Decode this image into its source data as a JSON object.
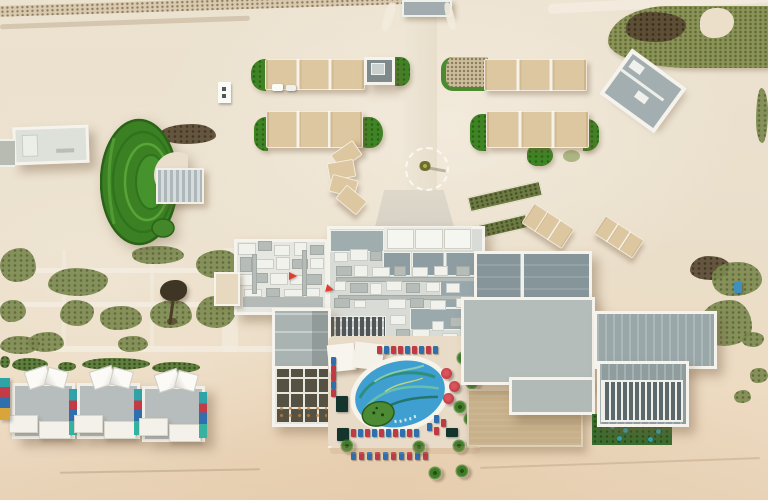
{
  "scene": {
    "type": "aerial-photograph",
    "subject": "top-down aerial view of a beachfront desert resort with amphitheater lawn, shade canopies, rooftop HVAC complex, mural swimming pool, beach villas and loungers"
  },
  "palette": {
    "sand": "#eadfcc",
    "beach": "#e8d4b9",
    "path": "#f3ecdf",
    "canopy": "#ddc7a0",
    "grass": "#3f8424",
    "grass_dark": "#2a6317",
    "olive": "#7d8b50",
    "scrub_dark": "#5a4a33",
    "roof_gray": "#a9b3b1",
    "roof_dark": "#869599",
    "concrete": "#b5bdba",
    "roof_light": "#e6e7e1",
    "tan_roof": "#c7b08a",
    "pool": "#3f9fd0",
    "teal": "#2f8f78",
    "lawn": "#3c6d2e",
    "red": "#c03a45",
    "blue": "#2f6fae",
    "flag": "#e23b30",
    "white": "#f5f3ec"
  },
  "objects": {
    "canopy_rows": [
      [
        265,
        59,
        98,
        29,
        0
      ],
      [
        484,
        59,
        101,
        30,
        0
      ],
      [
        266,
        111,
        95,
        35,
        0
      ],
      [
        486,
        111,
        101,
        35,
        0
      ],
      [
        524,
        214,
        46,
        22,
        33
      ],
      [
        596,
        226,
        44,
        20,
        33
      ]
    ],
    "canopy_fan": [
      [
        333,
        146,
        25,
        16,
        -35
      ],
      [
        328,
        161,
        25,
        16,
        -10
      ],
      [
        330,
        177,
        25,
        16,
        15
      ],
      [
        338,
        191,
        25,
        16,
        40
      ]
    ],
    "equipment": [
      [
        238,
        243,
        16,
        10,
        "w"
      ],
      [
        258,
        241,
        12,
        8,
        "g"
      ],
      [
        274,
        245,
        14,
        9,
        "w"
      ],
      [
        294,
        242,
        11,
        12,
        "w"
      ],
      [
        310,
        245,
        12,
        8,
        "g"
      ],
      [
        240,
        257,
        10,
        13,
        "g"
      ],
      [
        254,
        259,
        18,
        8,
        "w"
      ],
      [
        276,
        257,
        12,
        11,
        "w"
      ],
      [
        292,
        259,
        14,
        8,
        "g"
      ],
      [
        310,
        258,
        12,
        9,
        "w"
      ],
      [
        238,
        274,
        14,
        10,
        "w"
      ],
      [
        256,
        273,
        10,
        8,
        "g"
      ],
      [
        270,
        273,
        16,
        10,
        "w"
      ],
      [
        290,
        275,
        12,
        8,
        "w"
      ],
      [
        306,
        274,
        14,
        9,
        "g"
      ],
      [
        244,
        289,
        16,
        6,
        "w"
      ],
      [
        266,
        288,
        12,
        7,
        "g"
      ],
      [
        284,
        289,
        18,
        6,
        "w"
      ],
      [
        306,
        288,
        12,
        7,
        "w"
      ],
      [
        252,
        254,
        3,
        38,
        "g"
      ],
      [
        302,
        250,
        3,
        44,
        "g"
      ],
      [
        334,
        252,
        12,
        8,
        "w"
      ],
      [
        350,
        249,
        16,
        10,
        "w"
      ],
      [
        370,
        251,
        10,
        8,
        "g"
      ],
      [
        336,
        277,
        138,
        3,
        "g"
      ],
      [
        338,
        295,
        134,
        3,
        "g"
      ],
      [
        336,
        266,
        14,
        8,
        "g"
      ],
      [
        354,
        265,
        12,
        10,
        "w"
      ],
      [
        372,
        267,
        16,
        8,
        "w"
      ],
      [
        394,
        266,
        10,
        8,
        "g"
      ],
      [
        412,
        267,
        14,
        8,
        "w"
      ],
      [
        434,
        266,
        12,
        8,
        "w"
      ],
      [
        456,
        266,
        12,
        8,
        "g"
      ],
      [
        334,
        281,
        10,
        8,
        "w"
      ],
      [
        350,
        283,
        16,
        8,
        "g"
      ],
      [
        370,
        283,
        10,
        10,
        "w"
      ],
      [
        386,
        281,
        14,
        8,
        "w"
      ],
      [
        406,
        283,
        12,
        8,
        "g"
      ],
      [
        426,
        282,
        12,
        8,
        "w"
      ],
      [
        446,
        283,
        12,
        8,
        "w"
      ],
      [
        334,
        298,
        14,
        8,
        "g"
      ],
      [
        354,
        300,
        10,
        6,
        "w"
      ],
      [
        388,
        299,
        16,
        8,
        "w"
      ],
      [
        410,
        298,
        12,
        8,
        "g"
      ],
      [
        430,
        300,
        14,
        8,
        "w"
      ],
      [
        456,
        298,
        12,
        8,
        "w"
      ],
      [
        390,
        315,
        14,
        8,
        "w"
      ],
      [
        396,
        329,
        12,
        8,
        "g"
      ],
      [
        412,
        329,
        16,
        8,
        "w"
      ],
      [
        432,
        321,
        10,
        8,
        "w"
      ],
      [
        450,
        317,
        12,
        8,
        "g"
      ],
      [
        442,
        333,
        14,
        8,
        "w"
      ],
      [
        460,
        329,
        10,
        8,
        "w"
      ]
    ],
    "flags": [
      [
        289,
        272,
        0
      ],
      [
        326,
        285,
        15
      ]
    ],
    "loungers": [
      [
        377,
        346,
        "r"
      ],
      [
        384,
        346,
        "b"
      ],
      [
        391,
        346,
        "r"
      ],
      [
        398,
        346,
        "r"
      ],
      [
        405,
        346,
        "b"
      ],
      [
        412,
        346,
        "r"
      ],
      [
        419,
        346,
        "b"
      ],
      [
        426,
        346,
        "r"
      ],
      [
        433,
        346,
        "b"
      ],
      [
        331,
        357,
        "b"
      ],
      [
        331,
        365,
        "r"
      ],
      [
        331,
        373,
        "r"
      ],
      [
        331,
        381,
        "b"
      ],
      [
        331,
        389,
        "r"
      ],
      [
        434,
        415,
        "b"
      ],
      [
        441,
        419,
        "r"
      ],
      [
        427,
        423,
        "b"
      ],
      [
        434,
        427,
        "r"
      ],
      [
        351,
        429,
        "r"
      ],
      [
        358,
        429,
        "b"
      ],
      [
        365,
        429,
        "r"
      ],
      [
        372,
        429,
        "b"
      ],
      [
        379,
        429,
        "r"
      ],
      [
        386,
        429,
        "b"
      ],
      [
        393,
        429,
        "r"
      ],
      [
        400,
        429,
        "b"
      ],
      [
        407,
        429,
        "r"
      ],
      [
        414,
        429,
        "b"
      ],
      [
        351,
        452,
        "b"
      ],
      [
        359,
        452,
        "r"
      ],
      [
        367,
        452,
        "b"
      ],
      [
        375,
        452,
        "r"
      ],
      [
        383,
        452,
        "b"
      ],
      [
        391,
        452,
        "r"
      ],
      [
        399,
        452,
        "b"
      ],
      [
        407,
        452,
        "r"
      ],
      [
        415,
        452,
        "b"
      ],
      [
        423,
        452,
        "r"
      ]
    ],
    "umbrellas": [
      [
        441,
        368
      ],
      [
        449,
        381
      ],
      [
        443,
        393
      ]
    ],
    "dark_cabanas": [
      [
        336,
        396,
        12,
        16
      ],
      [
        337,
        428,
        12,
        13
      ],
      [
        446,
        428,
        12,
        9
      ]
    ],
    "palms": [
      [
        456,
        351
      ],
      [
        465,
        376
      ],
      [
        453,
        400
      ],
      [
        463,
        412
      ],
      [
        340,
        439
      ],
      [
        412,
        440
      ],
      [
        452,
        439
      ],
      [
        470,
        428
      ],
      [
        428,
        466
      ],
      [
        455,
        464
      ]
    ],
    "villas": [
      [
        12,
        383
      ],
      [
        77,
        383
      ],
      [
        142,
        386
      ]
    ],
    "scrub_patches": [
      [
        0,
        248,
        36,
        34,
        "g"
      ],
      [
        48,
        268,
        60,
        28,
        "g"
      ],
      [
        132,
        246,
        52,
        18,
        "g"
      ],
      [
        196,
        250,
        44,
        28,
        "g"
      ],
      [
        60,
        300,
        34,
        26,
        "g"
      ],
      [
        100,
        306,
        42,
        24,
        "g"
      ],
      [
        150,
        300,
        42,
        28,
        "g"
      ],
      [
        196,
        296,
        40,
        32,
        "g"
      ],
      [
        0,
        300,
        26,
        22,
        "g"
      ],
      [
        28,
        332,
        36,
        20,
        "g"
      ],
      [
        0,
        336,
        40,
        18,
        "g"
      ],
      [
        118,
        336,
        30,
        16,
        "g"
      ],
      [
        160,
        124,
        56,
        20,
        "d"
      ],
      [
        690,
        256,
        40,
        24,
        "d"
      ],
      [
        712,
        262,
        50,
        34,
        "g"
      ],
      [
        700,
        300,
        52,
        46,
        "g"
      ],
      [
        742,
        332,
        22,
        15,
        "g"
      ],
      [
        750,
        368,
        18,
        15,
        "g"
      ],
      [
        734,
        390,
        17,
        13,
        "g"
      ],
      [
        756,
        88,
        12,
        55,
        "g"
      ]
    ],
    "hedges": [
      [
        12,
        358,
        36,
        13
      ],
      [
        58,
        362,
        18,
        9
      ],
      [
        82,
        358,
        68,
        12
      ],
      [
        152,
        362,
        48,
        11
      ],
      [
        0,
        356,
        10,
        12
      ]
    ],
    "lawn_dots": [
      [
        610,
        424
      ],
      [
        623,
        428
      ],
      [
        641,
        422
      ],
      [
        656,
        429
      ],
      [
        617,
        436
      ],
      [
        648,
        437
      ]
    ]
  }
}
